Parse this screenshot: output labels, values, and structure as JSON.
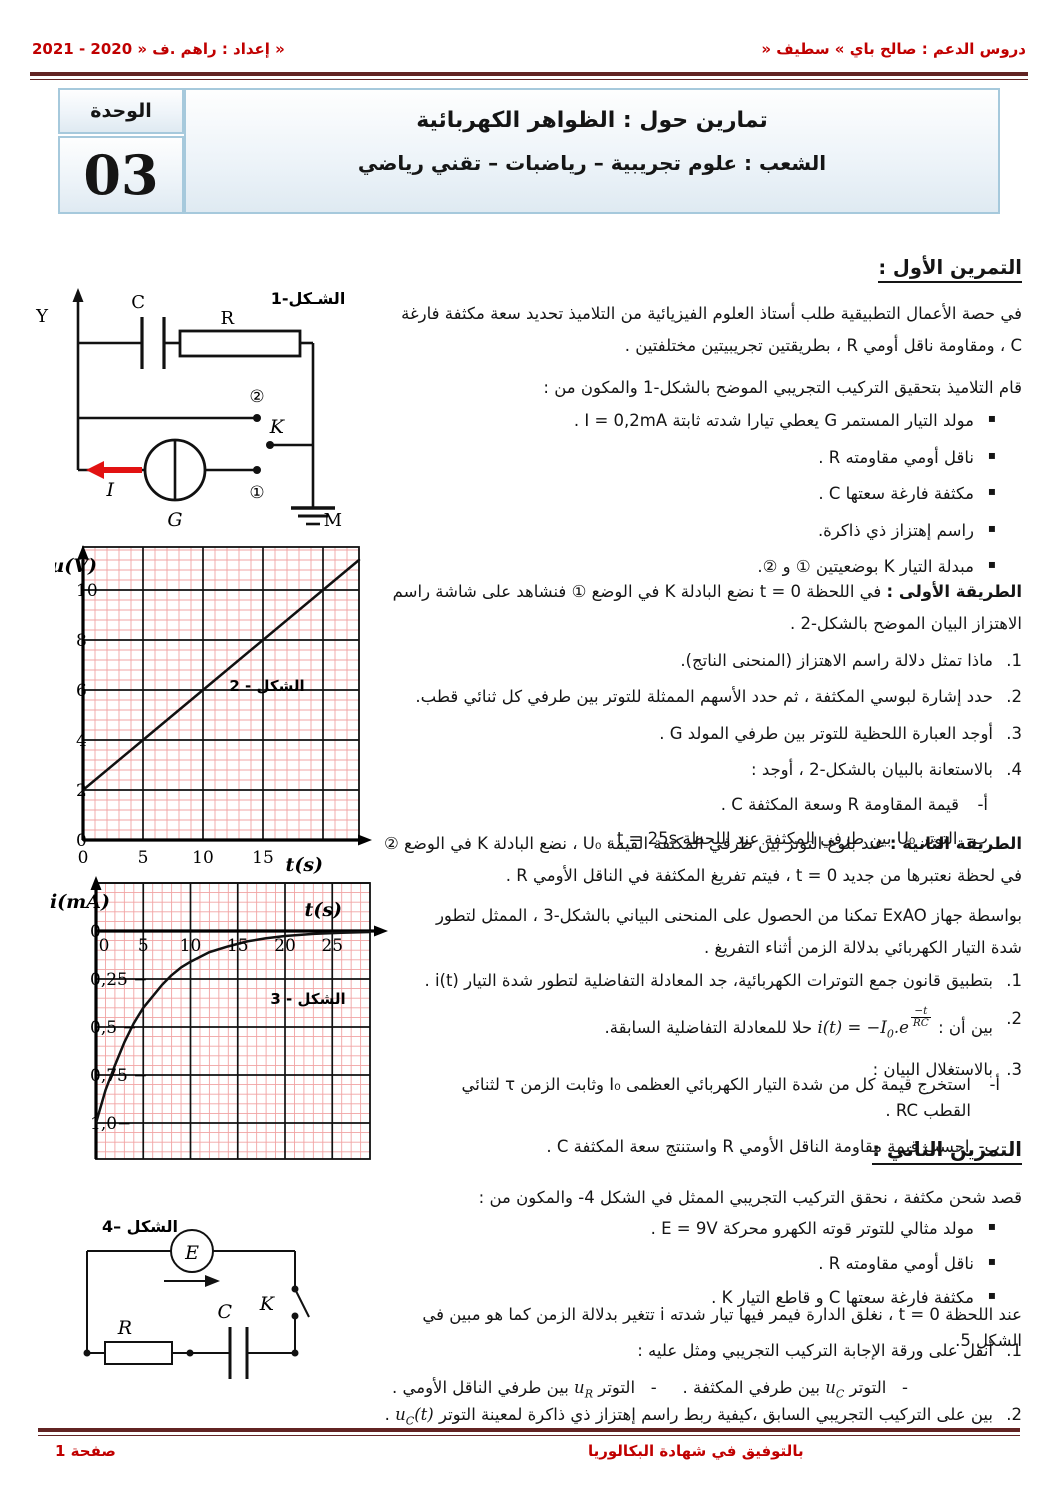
{
  "header": {
    "right": "دروس الدعم : صالح باي » سطيف «",
    "left": "إعداد : راهم .ف « 2020 - 2021 »"
  },
  "title_block": {
    "title": "تمارين حول : الظواهر الكهربائية",
    "subtitle": "الشعب : علوم تجريبية – رياضبات – تقني رياضي",
    "unit_label": "الوحدة",
    "unit_number": "03"
  },
  "exercise1": {
    "heading": "التمرين الأول :",
    "intro1": "في حصة الأعمال التطبيقية طلب أستاذ العلوم الفيزيائية من التلاميذ تحديد سعة مكثفة فارغة C ، ومقاومة ناقل أومي R ، بطريقتين تجريبيتين مختلفتين .",
    "intro2": "قام التلاميذ بتحقيق التركيب التجريبي الموضح بالشكل-1 والمكون من :",
    "components": [
      "مولد التيار المستمر G يعطي تيارا شدته ثابتة I = 0,2mA .",
      "ناقل أومي مقاومته R .",
      "مكثفة فارغة سعتها C .",
      "راسم إهتزاز ذي ذاكرة.",
      "مبدلة التيار K بوضعيتين ① و ②."
    ],
    "method1_label": "الطريقة الأولى :",
    "method1_text": " في اللحظة t = 0 نضع البادلة K في الوضع ① فنشاهد على شاشة راسم الاهتزاز البيان الموضح بالشكل-2 .",
    "questions": [
      {
        "num": "1.",
        "text": "ماذا تمثل دلالة راسم الاهتزاز (المنحنى الناتج)."
      },
      {
        "num": "2.",
        "text": "حدد إشارة لبوسي المكثفة ، ثم حدد الأسهم الممثلة للتوتر بين طرفي كل ثنائي قطب."
      },
      {
        "num": "3.",
        "text": "أوجد العبارة اللحظية للتوتر بين طرفي المولد G ."
      },
      {
        "num": "4.",
        "text": "بالاستعانة بالبيان بالشكل-2 ، أوجد :"
      }
    ],
    "sub_questions": [
      {
        "num": "أ-",
        "text": "قيمة المقاومة R وسعة المكثفة C ."
      },
      {
        "num": "ب-",
        "text": "التوتر U₀ بين طرفي المكثفة عند اللحظة t = 25s ."
      }
    ],
    "method2_label": "الطريقة الثانية :",
    "method2_text": " عند بلوغ التوتر بين طرفي المكثفة القيمة U₀ ، نضع البادلة K في الوضع ② في لحظة نعتبرها من جديد t = 0 ، فيتم تفريغ المكثفة في الناقل الأومي R .",
    "exao": "بواسطة جهاز ExAO تمكنا من الحصول على المنحنى البياني بالشكل-3 ، الممثل لتطور شدة التيار الكهربائي بدلالة الزمن أثناء التفريغ .",
    "questions2": [
      {
        "num": "1.",
        "text": "بتطبيق قانون جمع التوترات الكهربائية، جد المعادلة التفاضلية لتطور شدة التيار i(t) ."
      },
      {
        "num": "2.",
        "rich": [
          {
            "t": "بين أن : "
          },
          {
            "ltr": [
              {
                "v": "i(t) = −I"
              },
              {
                "sub": "0"
              },
              {
                "v": ".e"
              },
              {
                "frac": {
                  "num": "−t",
                  "den": "RC"
                }
              }
            ]
          },
          {
            "t": " حلا للمعادلة التفاضلية السابقة."
          }
        ]
      },
      {
        "num": "3.",
        "text": "بالاستغلال البيان :"
      }
    ],
    "sub_questions2": [
      {
        "num": "أ-",
        "text": "استخرج قيمة كل من شدة التيار الكهربائي العظمى I₀ وثابت الزمن τ لثنائي القطب RC ."
      },
      {
        "num": "ب-",
        "text": "احسب قيمة مقاومة الناقل الأومي R واستنتج سعة المكثفة C ."
      }
    ]
  },
  "exercise2": {
    "heading": "التمرين الثاني :",
    "intro": "قصد شحن مكثفة ، نحقق التركيب التجريبي الممثل في الشكل 4- والمكون من :",
    "components": [
      "مولد مثالي للتوتر قوته الكهرو محركة E = 9V .",
      "ناقل أومي مقاومته R .",
      "مكثفة فارغة سعتها C و قاطع التيار K ."
    ],
    "closing": "عند اللحظة t = 0 ، نغلق الدارة فيمر فيها تيار شدته i تتغير بدلالة الزمن كما هو مبين في الشكل 5.",
    "q1_num": "1.",
    "q1_text": "أنقل على ورقة الإجابة التركيب التجريبي ومثل عليه :",
    "q1a": [
      {
        "t": "-   التوتر "
      },
      {
        "ltr": [
          {
            "v": "u"
          },
          {
            "sub": "C"
          }
        ]
      },
      {
        "t": " بين طرفي المكثفة ."
      }
    ],
    "q1b": [
      {
        "t": "-   التوتر "
      },
      {
        "ltr": [
          {
            "v": "u"
          },
          {
            "sub": "R"
          }
        ]
      },
      {
        "t": " بين طرفي الناقل الأومي ."
      }
    ],
    "q2_num": "2.",
    "q2": [
      {
        "t": "بين على التركيب التجريبي السابق ،كيفية ربط راسم إهتزاز ذي ذاكرة لمعينة التوتر "
      },
      {
        "ltr": [
          {
            "v": "u"
          },
          {
            "sub": "C"
          },
          {
            "v": "(t)"
          }
        ]
      },
      {
        "t": " ."
      }
    ]
  },
  "figure1": {
    "label": "الشـكل-1",
    "y": "Y",
    "c": "C",
    "r": "R",
    "k": "K",
    "g": "G",
    "m": "M",
    "i": "I",
    "pos1": "①",
    "pos2": "②"
  },
  "figure4": {
    "label": "الشكل –4",
    "e": "E",
    "r": "R",
    "c": "C",
    "k": "K"
  },
  "footer": {
    "wish": "بالتوفيق في شهادة البكالوريا",
    "page": "صفحة 1"
  },
  "chart_data": [
    {
      "type": "line",
      "title": "الشكل - 2",
      "xlabel": "t(s)",
      "ylabel": "u(V)",
      "xlim": [
        0,
        23
      ],
      "ylim": [
        0,
        11.8
      ],
      "x_ticks": [
        0,
        5,
        10,
        15
      ],
      "x_tick_labels": [
        "0",
        "5",
        "10",
        "15"
      ],
      "y_ticks": [
        0,
        2,
        4,
        6,
        8,
        10
      ],
      "y_tick_labels": [
        "0",
        "2",
        "4",
        "6",
        "8",
        "10"
      ],
      "grid": true,
      "legend": false,
      "series": [
        {
          "name": "u(t) شحن المكثفة بتيار ثابت",
          "x": [
            0,
            5,
            10,
            15,
            20,
            23
          ],
          "y": [
            2,
            4,
            6,
            8,
            10,
            11.2
          ]
        }
      ]
    },
    {
      "type": "line",
      "title": "الشكل - 3",
      "xlabel": "t(s)",
      "ylabel": "i(mA)",
      "xlim": [
        0,
        29
      ],
      "ylim": [
        -1.15,
        0.25
      ],
      "x_ticks": [
        0,
        5,
        10,
        15,
        20,
        25
      ],
      "x_tick_labels": [
        "0",
        "5",
        "10",
        "15",
        "20",
        "25"
      ],
      "y_ticks": [
        0,
        -0.25,
        -0.5,
        -0.75,
        -1.0
      ],
      "y_tick_labels": [
        "0",
        "− 0,25",
        "− 0,5",
        "− 0,75",
        "−1,0"
      ],
      "grid": true,
      "legend": false,
      "series": [
        {
          "name": "i(t) تفريغ المكثفة",
          "x": [
            0,
            1,
            2,
            3,
            4,
            5,
            6,
            7,
            8,
            9,
            10,
            12,
            14,
            16,
            18,
            20,
            23,
            26,
            29
          ],
          "y": [
            -1.0,
            -0.83,
            -0.7,
            -0.58,
            -0.48,
            -0.4,
            -0.34,
            -0.28,
            -0.23,
            -0.19,
            -0.16,
            -0.11,
            -0.08,
            -0.054,
            -0.038,
            -0.026,
            -0.015,
            -0.009,
            -0.005
          ]
        }
      ]
    }
  ]
}
